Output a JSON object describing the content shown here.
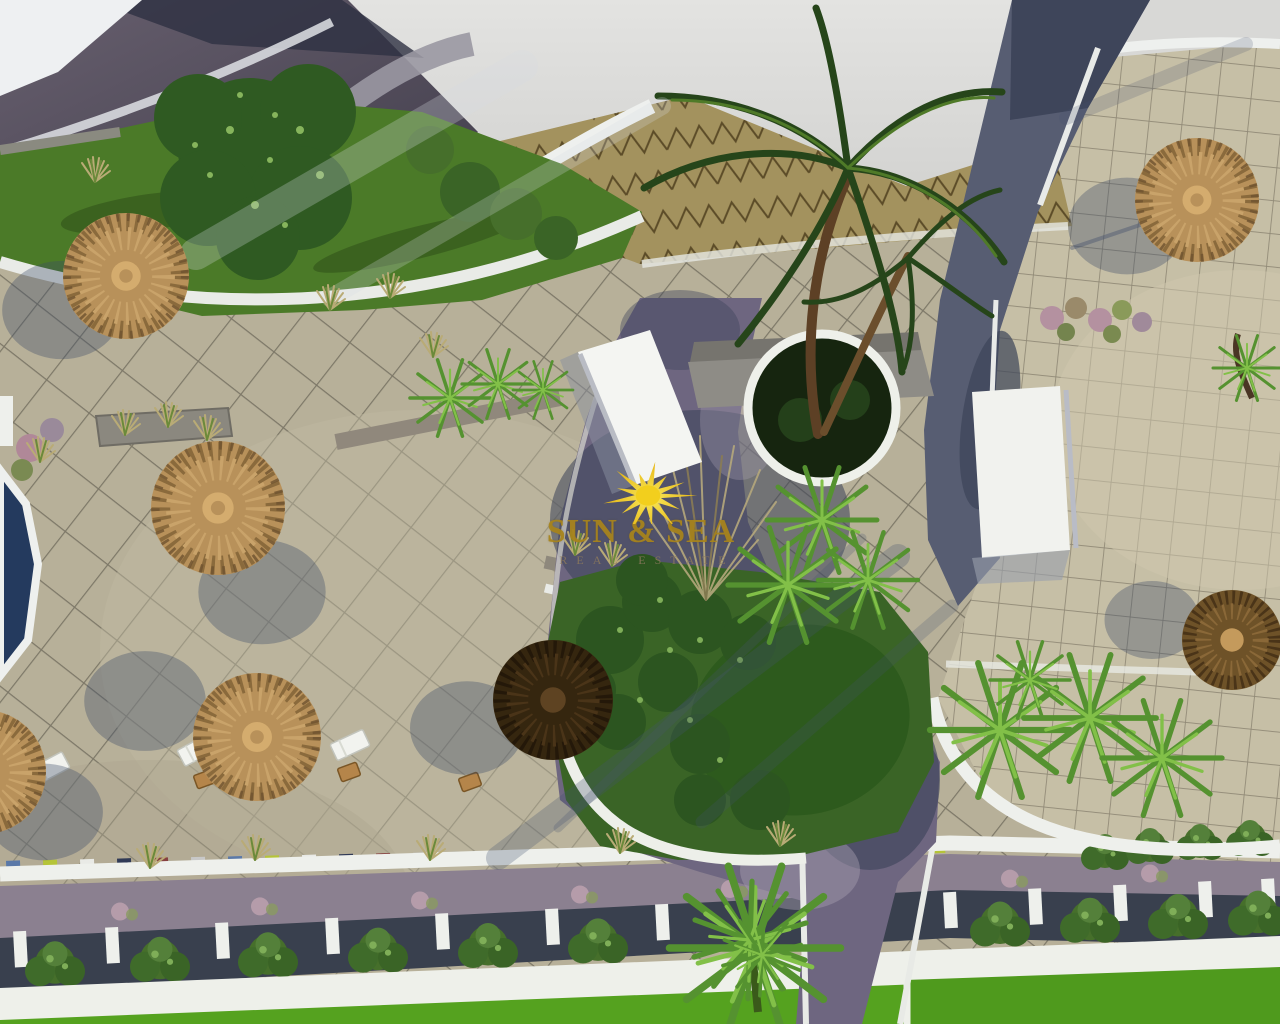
{
  "scene": {
    "type": "aerial-3d-architectural-render",
    "description": "Aerial view of a resort courtyard: beige paved plazas, dark cobblestone paths, thatched straw parasols, sun loungers, palm trees, green garden islands, a pool corner and a bottom walkway with planter boxes and bright lawn",
    "watermark": {
      "title": "SUN & SEA",
      "subtitle": "REAL ESTATE",
      "title_color": "#a8841c",
      "subtitle_color": "#8a785c",
      "sun_color": "#f2cf1d"
    },
    "palette": {
      "pavement_left": "#b7b099",
      "pavement_right": "#c6bfa6",
      "grid_line": "#3c3a35",
      "path_dark": "#3e4459",
      "path_light": "#8e8494",
      "walkway": "#8b8090",
      "white_wall": "#eef0ec",
      "planter_dark": "#39404e",
      "lawn_bright": "#55a21f",
      "garden_green": "#4b7a28",
      "island_lawn": "#2d5a1d",
      "bush_green": "#3a6426",
      "fern_green": "#6fae3e",
      "tree_green": "#2f5a22",
      "thatch_light": "#c9a36a",
      "thatch_dark": "#2f2212",
      "pool_navy": "#243a5e",
      "roof_slate": "#57525e",
      "roof_tile_tan": "#a3925e",
      "sky_gray": "#d7d7d5"
    },
    "objects": {
      "umbrellas": [
        {
          "x": 126,
          "y": 276,
          "r": 63,
          "tone": "light",
          "sdx": -64,
          "sdy": 34
        },
        {
          "x": 218,
          "y": 508,
          "r": 67,
          "tone": "light",
          "sdx": 44,
          "sdy": 84
        },
        {
          "x": 257,
          "y": 737,
          "r": 64,
          "tone": "light",
          "sdx": -112,
          "sdy": -36
        },
        {
          "x": 553,
          "y": 700,
          "r": 60,
          "tone": "dark",
          "sdx": -86,
          "sdy": 28
        },
        {
          "x": 1197,
          "y": 200,
          "r": 62,
          "tone": "light",
          "sdx": -70,
          "sdy": 26
        },
        {
          "x": 1232,
          "y": 640,
          "r": 50,
          "tone": "brown",
          "sdx": -80,
          "sdy": -20
        },
        {
          "x": -16,
          "y": 772,
          "r": 62,
          "tone": "light",
          "sdx": 60,
          "sdy": 40
        }
      ],
      "loungers": [
        {
          "x": 50,
          "y": 768,
          "rot": -28
        },
        {
          "x": 197,
          "y": 750,
          "rot": -28
        },
        {
          "x": 350,
          "y": 745,
          "rot": -25
        }
      ],
      "chairs": [
        {
          "x": 349,
          "y": 772
        },
        {
          "x": 205,
          "y": 779
        },
        {
          "x": 470,
          "y": 782
        }
      ],
      "grass_tufts": [
        [
          390,
          288
        ],
        [
          95,
          172
        ],
        [
          433,
          347
        ],
        [
          150,
          858
        ],
        [
          255,
          850
        ],
        [
          430,
          850
        ],
        [
          620,
          843
        ],
        [
          780,
          836
        ],
        [
          575,
          545
        ],
        [
          612,
          556
        ],
        [
          125,
          425
        ],
        [
          168,
          417
        ],
        [
          207,
          430
        ],
        [
          40,
          452
        ],
        [
          330,
          300
        ]
      ],
      "ferns": [
        [
          1000,
          730,
          70
        ],
        [
          1090,
          718,
          66
        ],
        [
          1162,
          758,
          60
        ],
        [
          822,
          520,
          55
        ],
        [
          788,
          585,
          60
        ],
        [
          868,
          580,
          50
        ],
        [
          450,
          398,
          40
        ],
        [
          498,
          384,
          36
        ],
        [
          543,
          390,
          30
        ],
        [
          1247,
          368,
          34
        ],
        [
          1030,
          680,
          40
        ]
      ],
      "walkway_plants_x": [
        120,
        260,
        420,
        580,
        730,
        870,
        1010,
        1150
      ],
      "accent_cubes": {
        "colors": [
          "#5b79a8",
          "#b5c438",
          "#e9eae6",
          "#303a56",
          "#874040",
          "#c8c8c8"
        ],
        "start_x": 6,
        "end_x": 948,
        "step": 37
      },
      "planter_posts_x": [
        20,
        112,
        222,
        332,
        442,
        552,
        662,
        950,
        1035,
        1120,
        1205,
        1268
      ],
      "planter_bushes_x": [
        55,
        160,
        268,
        378,
        488,
        598,
        1000,
        1090,
        1178,
        1258
      ],
      "edge_bushes": [
        [
          1105,
          852
        ],
        [
          1150,
          846
        ],
        [
          1200,
          842
        ],
        [
          1250,
          838
        ]
      ]
    }
  }
}
